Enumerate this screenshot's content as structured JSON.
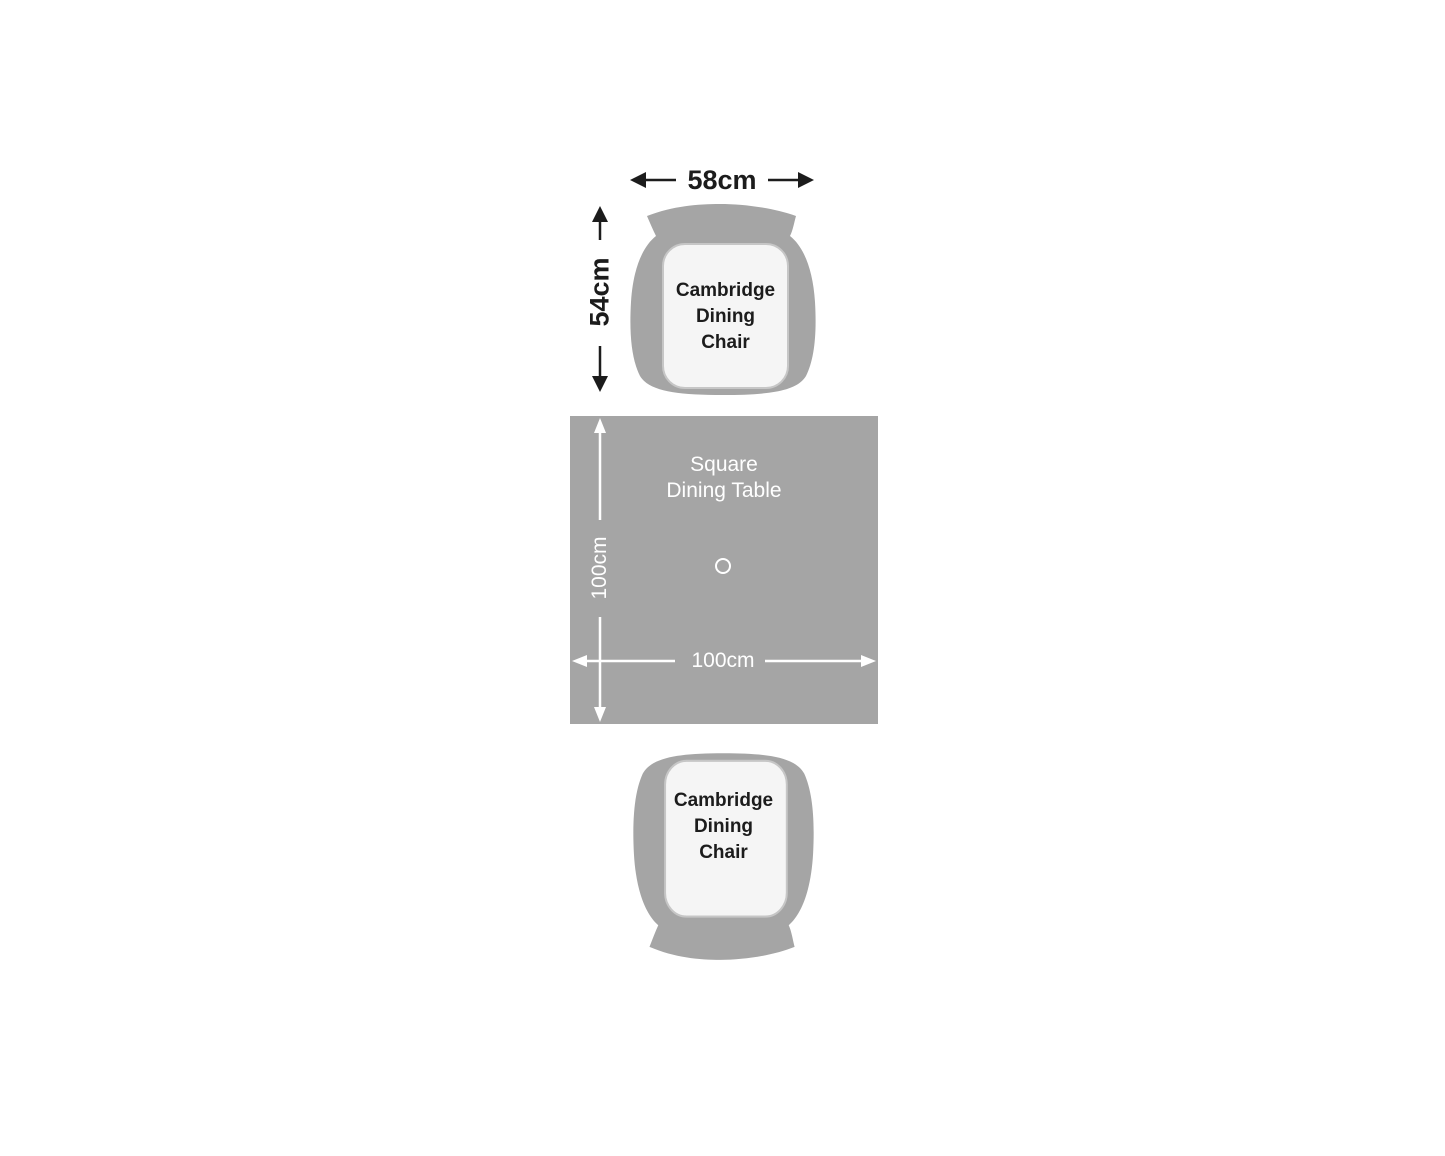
{
  "diagram_type": "dining-set-top-view-dimension-plan",
  "colors": {
    "background": "#ffffff",
    "furniture_gray": "#a5a5a5",
    "cushion_fill": "#f5f5f5",
    "cushion_border": "#c6c6c6",
    "dimension_black": "#1c1c1c",
    "dimension_white": "#ffffff"
  },
  "chairs": {
    "top": {
      "name_lines": [
        "Cambridge",
        "Dining",
        "Chair"
      ],
      "width_label": "58cm",
      "depth_label": "54cm"
    },
    "bottom": {
      "name_lines": [
        "Cambridge",
        "Dining",
        "Chair"
      ]
    }
  },
  "table": {
    "name_lines": [
      "Square",
      "Dining Table"
    ],
    "width_label": "100cm",
    "depth_label": "100cm"
  },
  "icons": {
    "table_center_mark": "circle-outline",
    "dimension_arrows": "double-headed-arrow"
  }
}
